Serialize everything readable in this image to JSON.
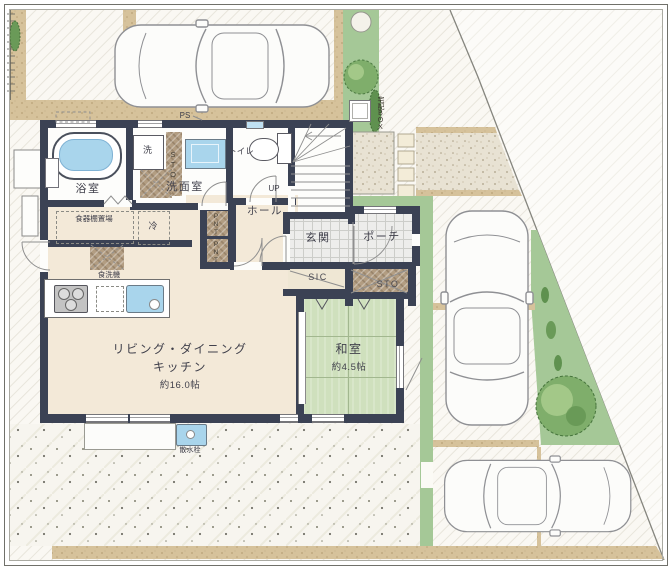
{
  "plan": {
    "rooms": {
      "bath": {
        "label": "浴室"
      },
      "washroom": {
        "label": "洗面室",
        "storage_label": "STO"
      },
      "toilet": {
        "label": "トイレ"
      },
      "hall": {
        "label": "ホール"
      },
      "stairs": {
        "up_label": "UP"
      },
      "entry": {
        "label": "玄関"
      },
      "porch": {
        "label": "ポーチ"
      },
      "shoe_closet": {
        "label": "SIC"
      },
      "entry_storage": {
        "label": "STO"
      },
      "pantry_upper": {
        "label": "PNT"
      },
      "pantry_lower": {
        "label": "PNT"
      },
      "ldk": {
        "label_line1": "リビング・ダイニング",
        "label_line2": "キッチン",
        "size": "約16.0帖"
      },
      "washitsu": {
        "label": "和室",
        "size": "約4.5帖"
      }
    },
    "equipment": {
      "washer": "洗",
      "fridge": "冷",
      "dishwasher": "食洗機",
      "dish_shelf": "食器棚置場",
      "pipe_space": "PS",
      "delivery_box": "宅配BOX",
      "water_tap": "散水栓"
    },
    "colors": {
      "wall": "#3b4254",
      "floor": "#f3e9d8",
      "tatami": "#cfe0bd",
      "water": "#a9d5ec",
      "greenery": "#a5c897",
      "path_tan": "#d6c29b"
    }
  }
}
